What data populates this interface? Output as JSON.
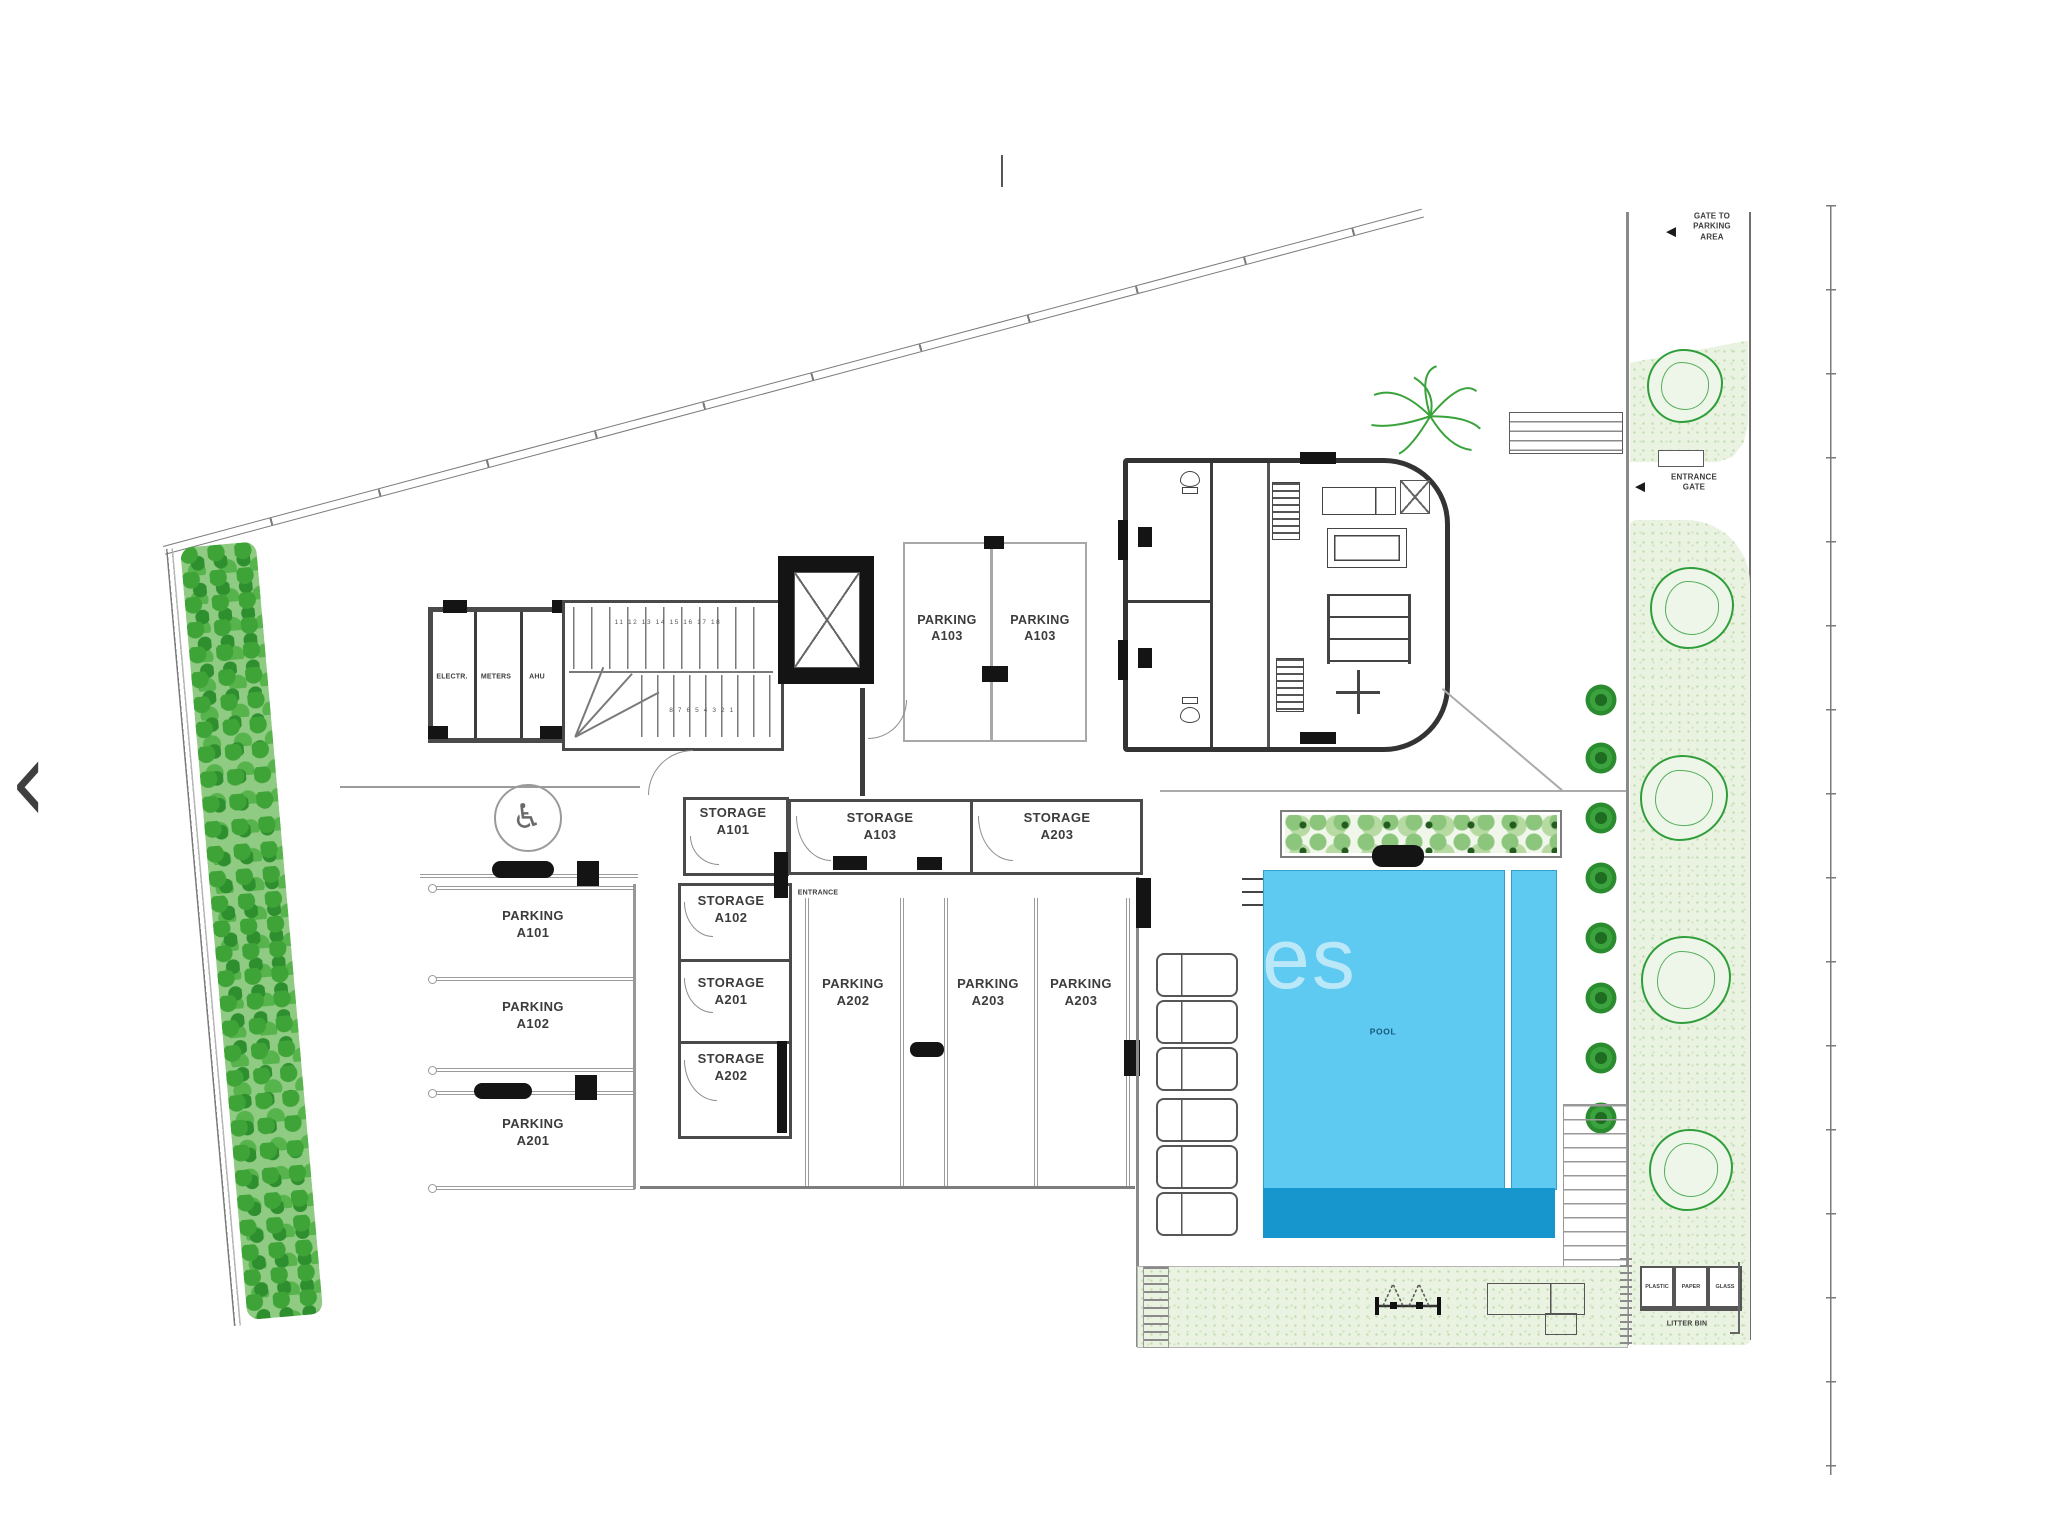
{
  "viewer": {
    "prev": "‹"
  },
  "icons": {
    "gate_arrow": "◀",
    "accessible_parking": "♿"
  },
  "annotations": {
    "gate_to_parking": "GATE TO\nPARKING\nAREA",
    "entrance_gate": "ENTRANCE\nGATE",
    "entrance": "ENTRANCE",
    "pool": "POOL",
    "litter_bin": "LITTER BIN"
  },
  "bins": {
    "plastic": "PLASTIC",
    "paper": "PAPER",
    "glass": "GLASS"
  },
  "utility_rooms": {
    "electrical": "ELECTR.",
    "meters": "METERS",
    "ahu": "AHU"
  },
  "stairs": {
    "upper_run": "11 12 13 14 15 16 17 18",
    "lower_run": "8 7 6 5 4 3 2 1"
  },
  "parking": {
    "a103_left": "PARKING\nA103",
    "a103_right": "PARKING\nA103",
    "a101": "PARKING\nA101",
    "a102": "PARKING\nA102",
    "a201": "PARKING\nA201",
    "a202": "PARKING\nA202",
    "a203_left": "PARKING\nA203",
    "a203_right": "PARKING\nA203"
  },
  "storage": {
    "a101": "STORAGE\nA101",
    "a102": "STORAGE\nA102",
    "a201": "STORAGE\nA201",
    "a202": "STORAGE\nA202",
    "a103": "STORAGE\nA103",
    "a203": "STORAGE\nA203"
  },
  "watermark": "es",
  "colors": {
    "pool_light": "#5ec9f1",
    "pool_dark": "#1796cd",
    "tree_green": "#2f9e3a"
  }
}
